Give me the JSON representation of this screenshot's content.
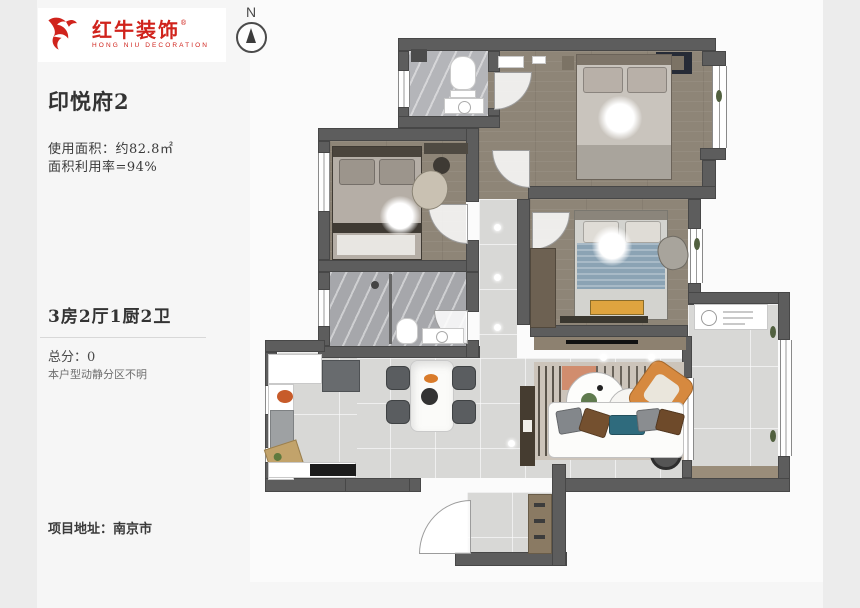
{
  "logo": {
    "brand_cn": "红牛装饰",
    "brand_en": "HONG NIU DECORATION",
    "registered_mark": "®",
    "brand_color": "#d0231c"
  },
  "compass": {
    "label": "N"
  },
  "info": {
    "title": "印悦府2",
    "usable_area": "使用面积：约82.8㎡",
    "utilization": "面积利用率=94%",
    "layout": "3房2厅1厨2卫",
    "score": "总分：0",
    "score_note": "本户型动静分区不明",
    "address": "项目地址：南京市"
  },
  "floorplan_palette": {
    "wall": "#5d5d5d",
    "wood_floor": "#8e8577",
    "tile_floor": "#d8d8d6",
    "marble_bath": "#b4b5b9",
    "accent_orange": "#d6893f",
    "accent_blue": "#8ba3b4",
    "accent_yellow": "#dfa43f"
  }
}
